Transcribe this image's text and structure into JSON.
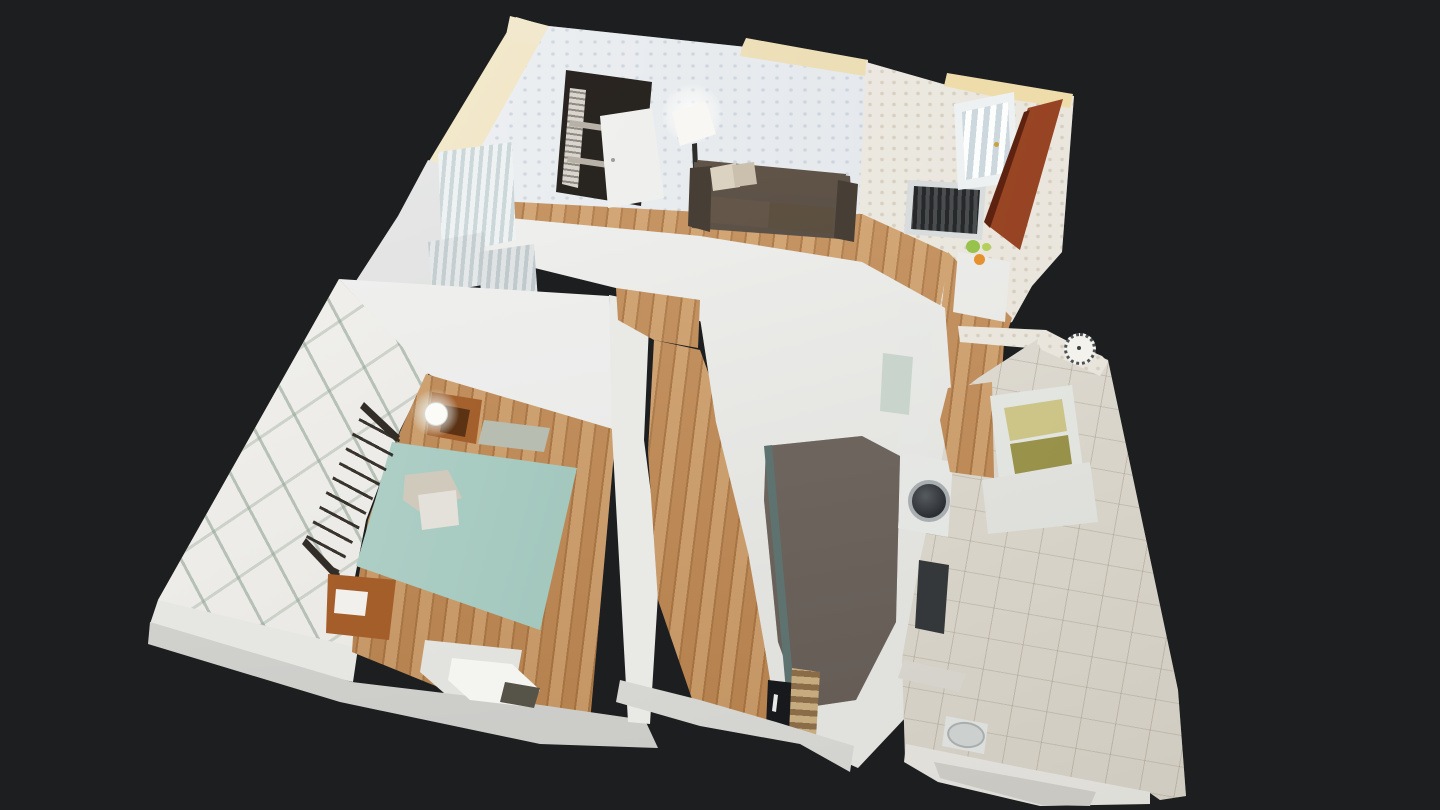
{
  "app": {
    "name": "3d-tour-viewer",
    "view_mode": "dollhouse",
    "visible_text": "none"
  },
  "scene": {
    "description_labels": {
      "living_room": "living-room",
      "entry_hall": "entry-hall",
      "bedroom": "bedroom",
      "hallway": "hallway",
      "kitchen": "kitchen",
      "bathroom": "bathroom"
    },
    "rooms": [
      {
        "name": "living-room",
        "features": [
          "floral-wallpaper",
          "bookshelf",
          "leaning-white-door-panel",
          "floor-lamp",
          "dark-leather-loveseat",
          "radiator-grille",
          "oak-floor"
        ]
      },
      {
        "name": "entry-hall",
        "features": [
          "rust-red-front-door",
          "curtained-window",
          "white-cabinet",
          "fruit-on-cabinet",
          "oak-floor"
        ]
      },
      {
        "name": "bedroom",
        "features": [
          "fern-pattern-wallpaper",
          "mint-double-bed",
          "black-metal-headboard",
          "wooden-nightstand-with-lamp",
          "wooden-nightstand-with-drawer",
          "grey-rug",
          "oak-floor"
        ]
      },
      {
        "name": "hallway",
        "features": [
          "oak-floor",
          "white-door-frames"
        ]
      },
      {
        "name": "kitchen",
        "features": [
          "blurred-unscanned-patch",
          "teal-counter-edge",
          "dark-appliance",
          "striped-drawers",
          "washing-machine"
        ]
      },
      {
        "name": "bathroom",
        "features": [
          "white-tile-floor",
          "yellow-glass-window",
          "wall-clock",
          "shelf",
          "toilet",
          "bathtub"
        ]
      }
    ],
    "colors": {
      "background": "#1d1e20",
      "wood": "#c18a54",
      "quilt": "#a7ccc2",
      "door": "#973f1e",
      "sofa": "#4d4339",
      "tile": "#e2dfd7",
      "wallpaper_living": "#e8ebee",
      "wallpaper_entry": "#e9e5dc",
      "fern": "#e7e5df",
      "cream": "#eeddab",
      "white_wall": "#e9e9e6",
      "kitchen_blur": "#7d746e",
      "metal_dark": "#34383a",
      "lamp_glow": "#ffffff",
      "fruit_green": "#97c24c",
      "fruit_orange": "#e4922f"
    }
  }
}
